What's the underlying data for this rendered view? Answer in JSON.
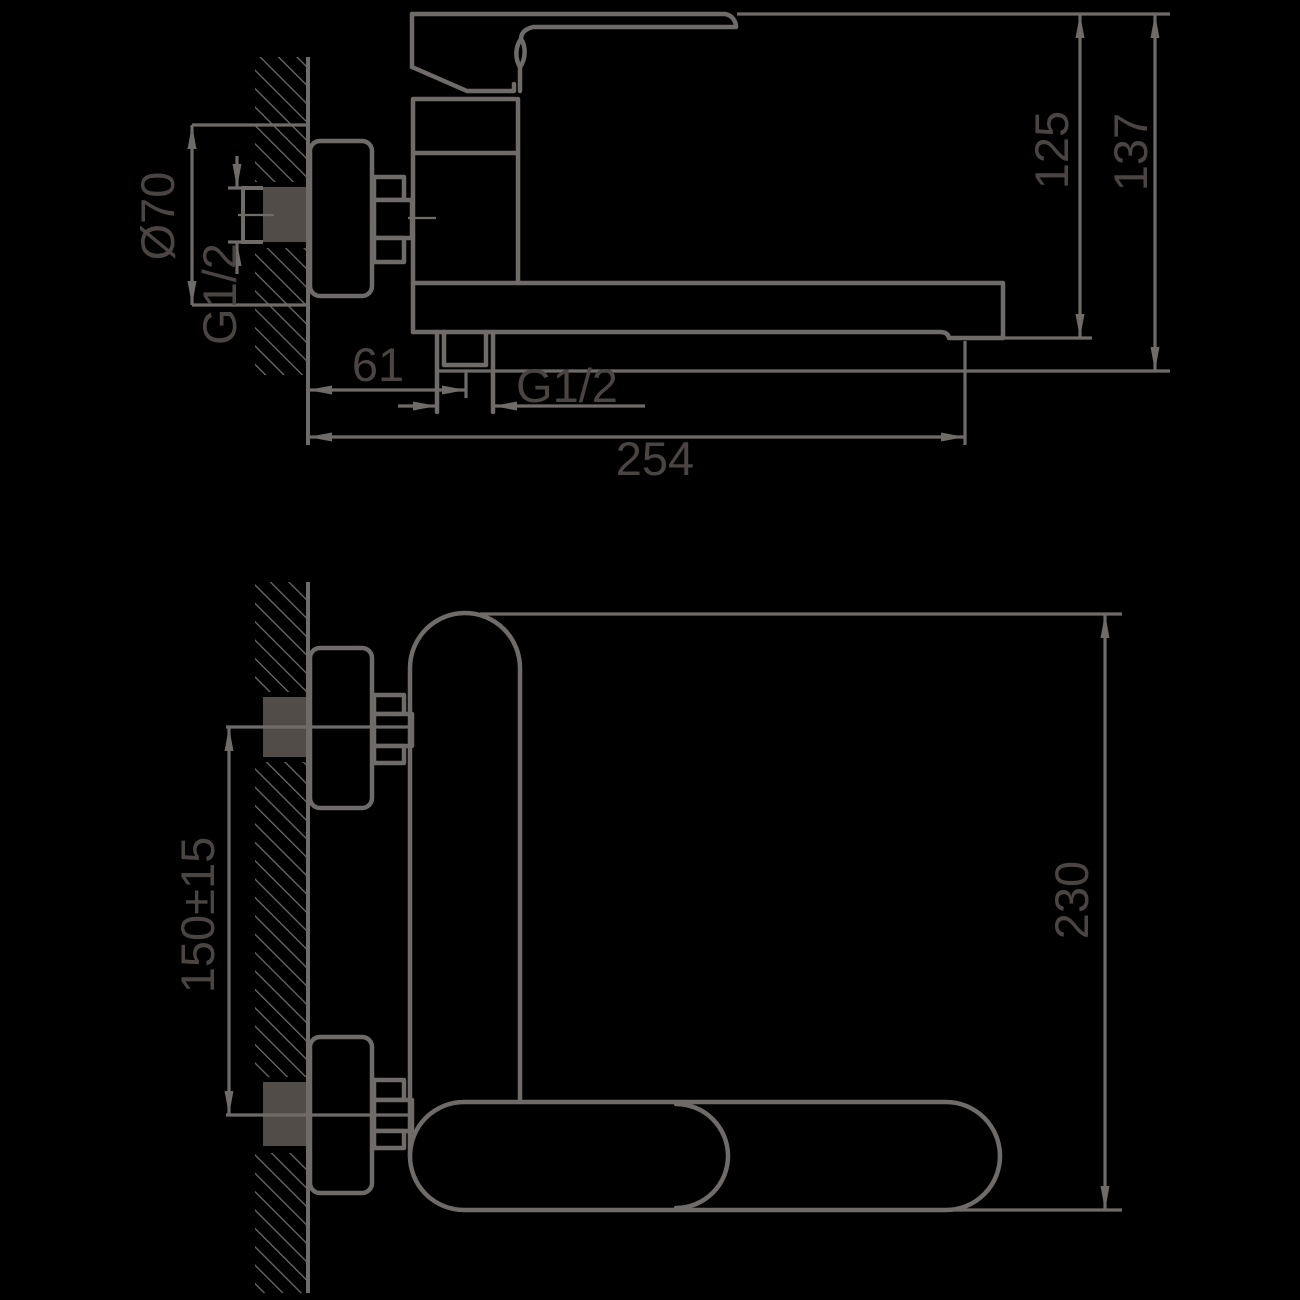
{
  "drawing": {
    "kind": "faucet-installation-dimension-drawing",
    "colors": {
      "background": "#000000",
      "line": "#6f6b69",
      "text": "#4a4442",
      "wall_socket_fill": "#524c49"
    },
    "side_view": {
      "escutcheon_diameter": "Ø70",
      "wall_connection_thread": "G1/2",
      "wall_to_shower_outlet": "61",
      "shower_outlet_thread": "G1/2",
      "spout_reach": "254",
      "top_to_spout_bottom": "125",
      "top_to_outlet_bottom": "137"
    },
    "plan_view": {
      "connection_centers_distance": "150±15",
      "projection_depth": "230"
    }
  }
}
